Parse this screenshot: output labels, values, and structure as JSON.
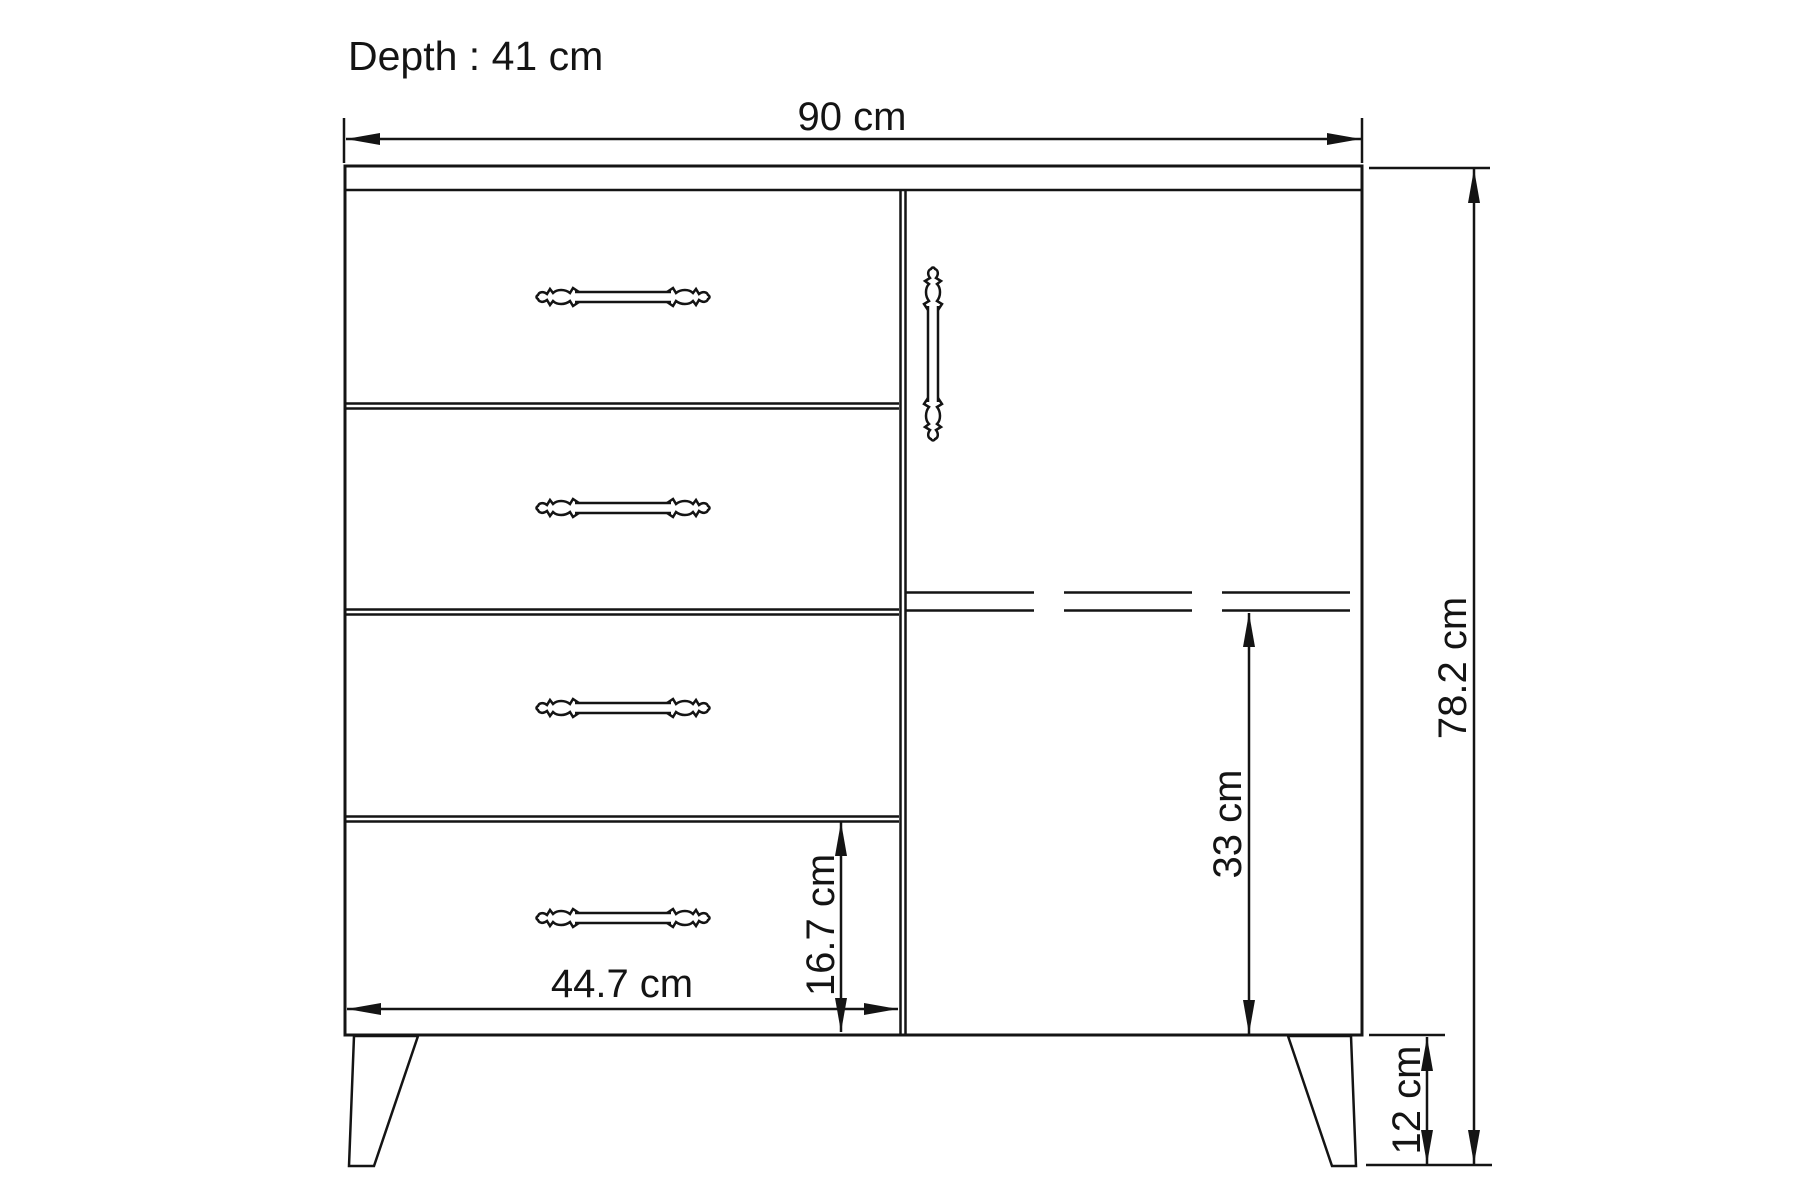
{
  "drawing": {
    "depth_note": "Depth : 41 cm",
    "overall_width": "90 cm",
    "overall_height": "78.2 cm",
    "door_opening_height": "33 cm",
    "bottom_drawer_height": "16.7 cm",
    "drawer_width": "44.7 cm",
    "leg_height": "12 cm"
  },
  "figure": {
    "drawer_count": 4,
    "door_count": 1,
    "leg_count": 2,
    "handle_count": 5
  },
  "colors": {
    "line": "#141414",
    "background": "#ffffff"
  }
}
